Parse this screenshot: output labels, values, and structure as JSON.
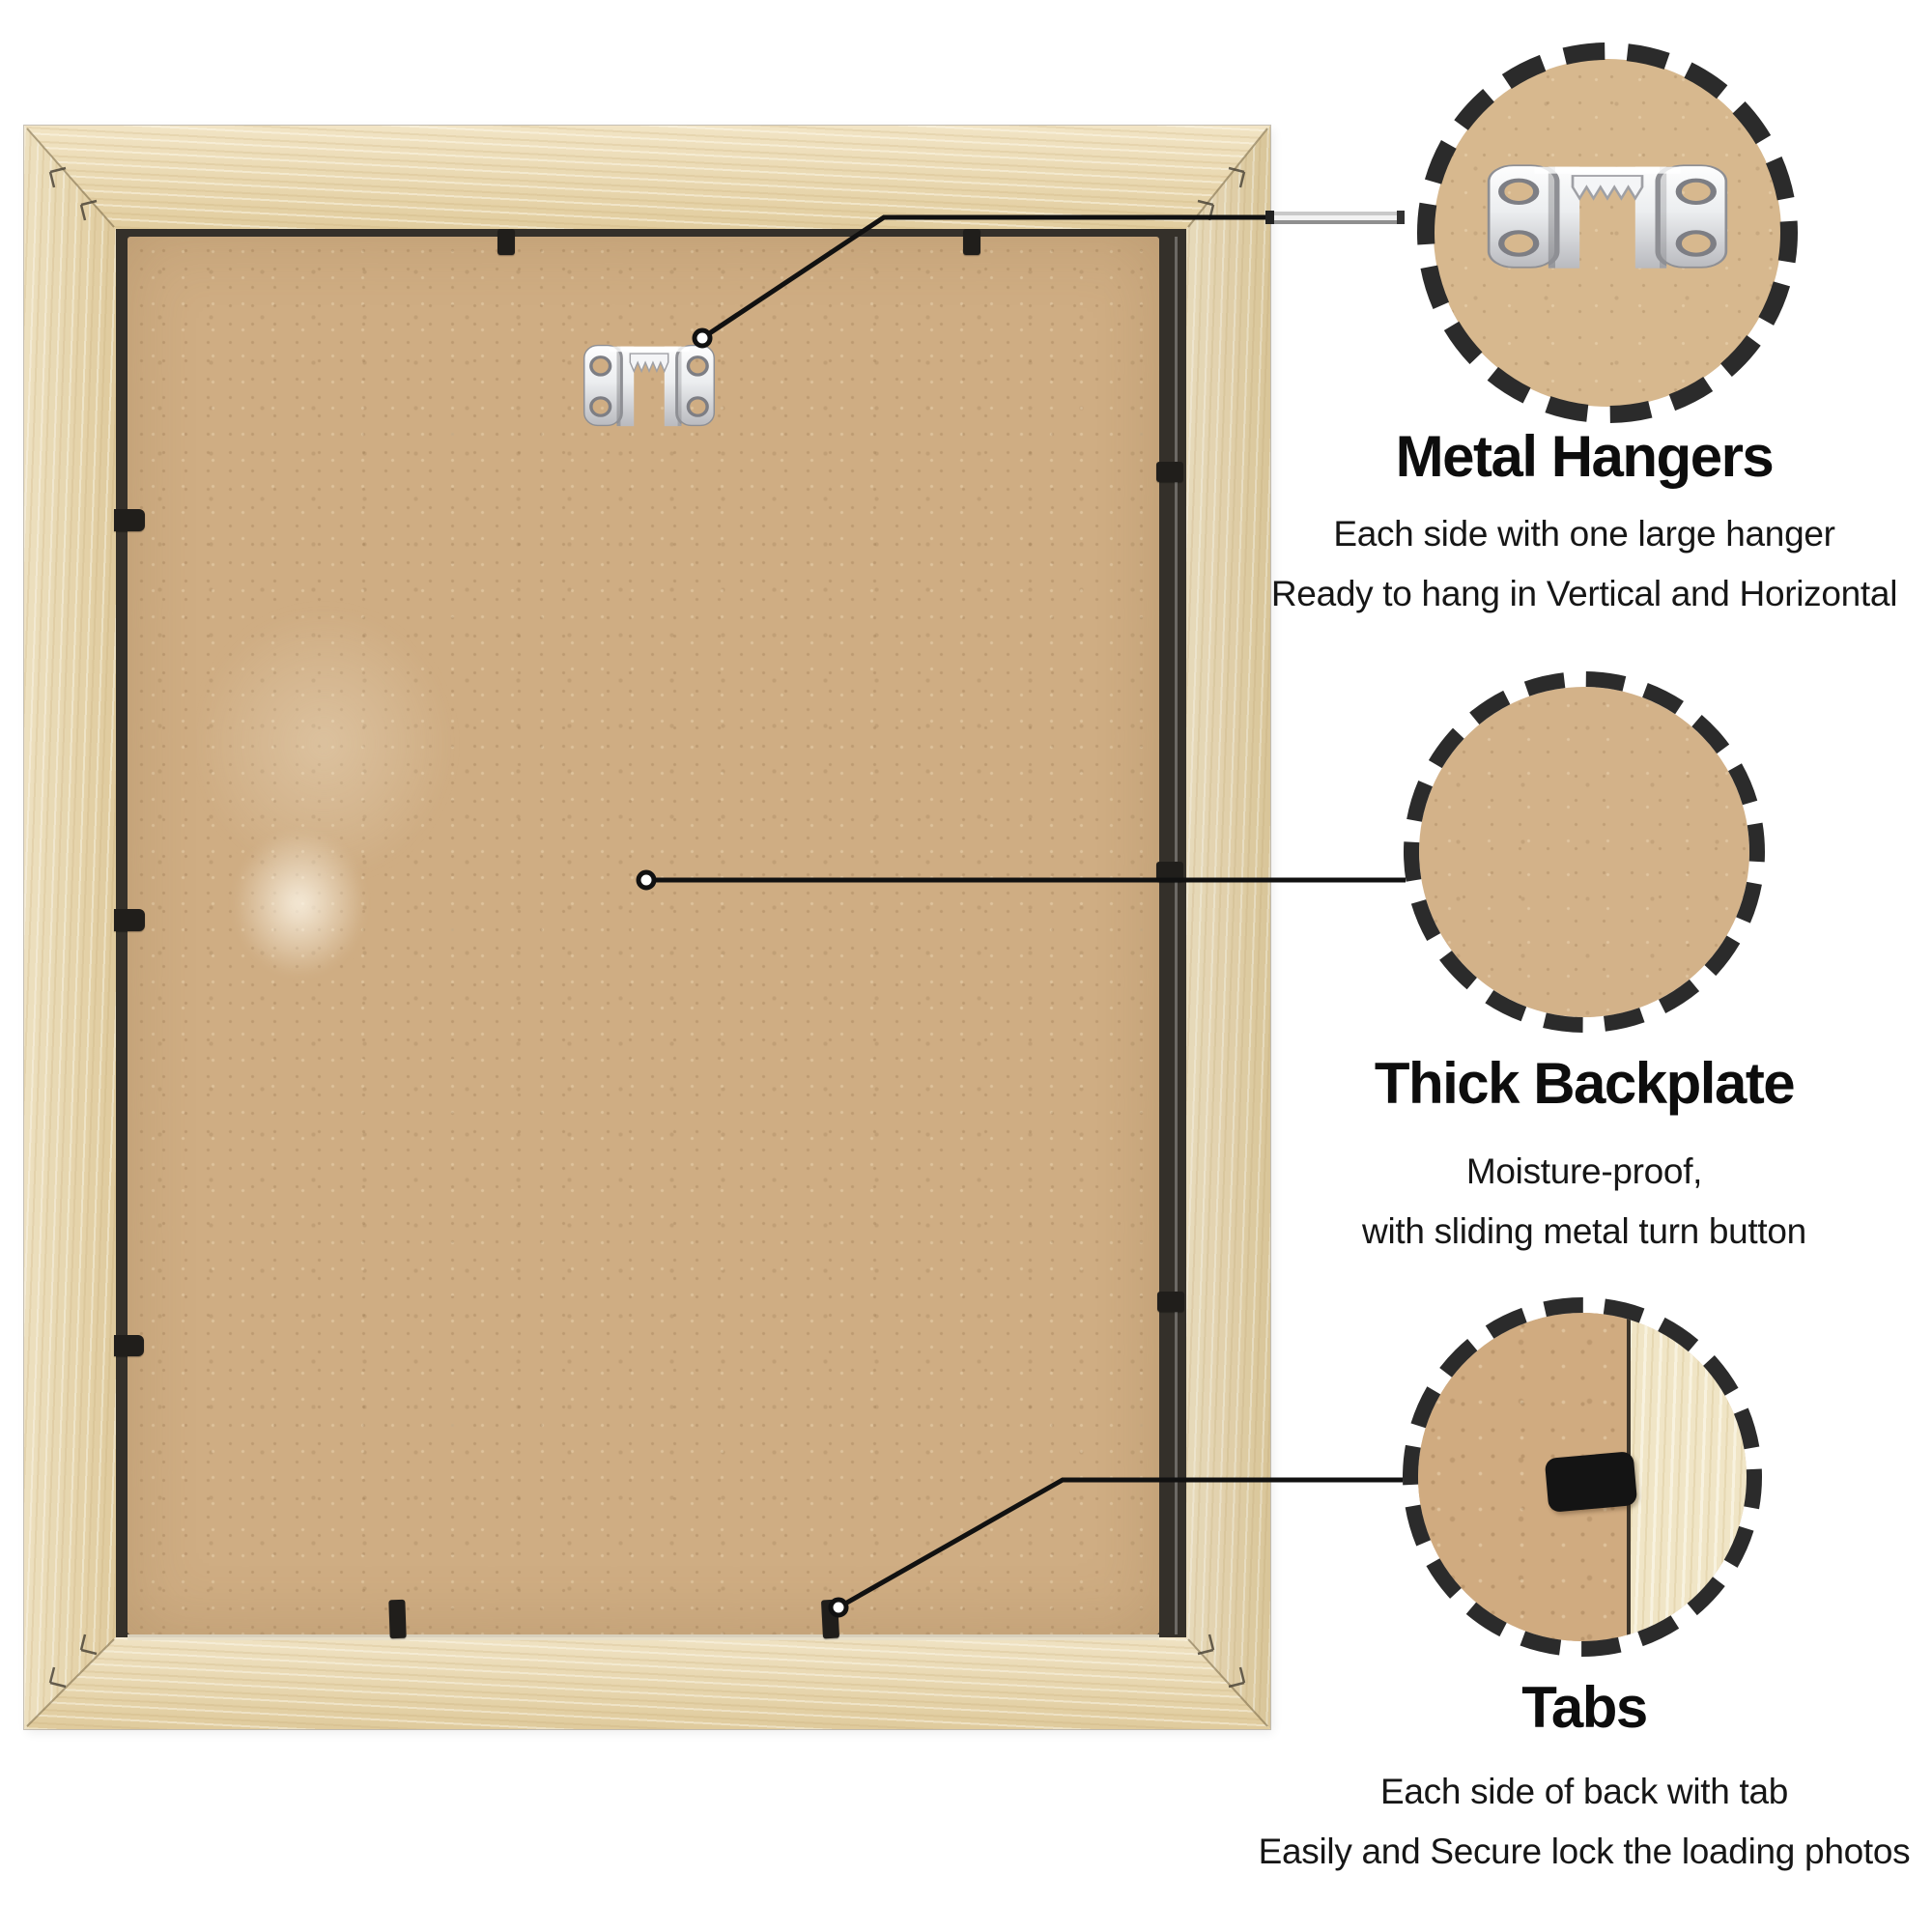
{
  "page": {
    "kind": "product infographic – back of a wooden picture frame with feature callouts",
    "background_color": "#ffffff"
  },
  "palette": {
    "wood": "#ecd9ac",
    "wood_light": "#f0e5c6",
    "mdf_backplate": "#cfad83",
    "opening_shadow": "#34302a",
    "tab_black": "#201e1b",
    "callout_line": "#111111",
    "dashed_ring": "#2b2b2b",
    "metal_hanger": "#eceef0",
    "text": "#0d0d0d"
  },
  "icons": [
    "sawtooth-hanger-icon",
    "dashed-circle-ring",
    "callout-marker-dot",
    "locking-tab-icon"
  ],
  "callouts": [
    {
      "id": "metal-hangers",
      "title": "Metal Hangers",
      "desc_line1": "Each side with one large hanger",
      "desc_line2": "Ready to hang in Vertical and Horizontal"
    },
    {
      "id": "thick-backplate",
      "title": "Thick Backplate",
      "desc_line1": "Moisture-proof,",
      "desc_line2": "with sliding metal turn button"
    },
    {
      "id": "tabs",
      "title": "Tabs",
      "desc_line1": "Each side of back with tab",
      "desc_line2": "Easily and Secure lock the loading photos"
    }
  ]
}
